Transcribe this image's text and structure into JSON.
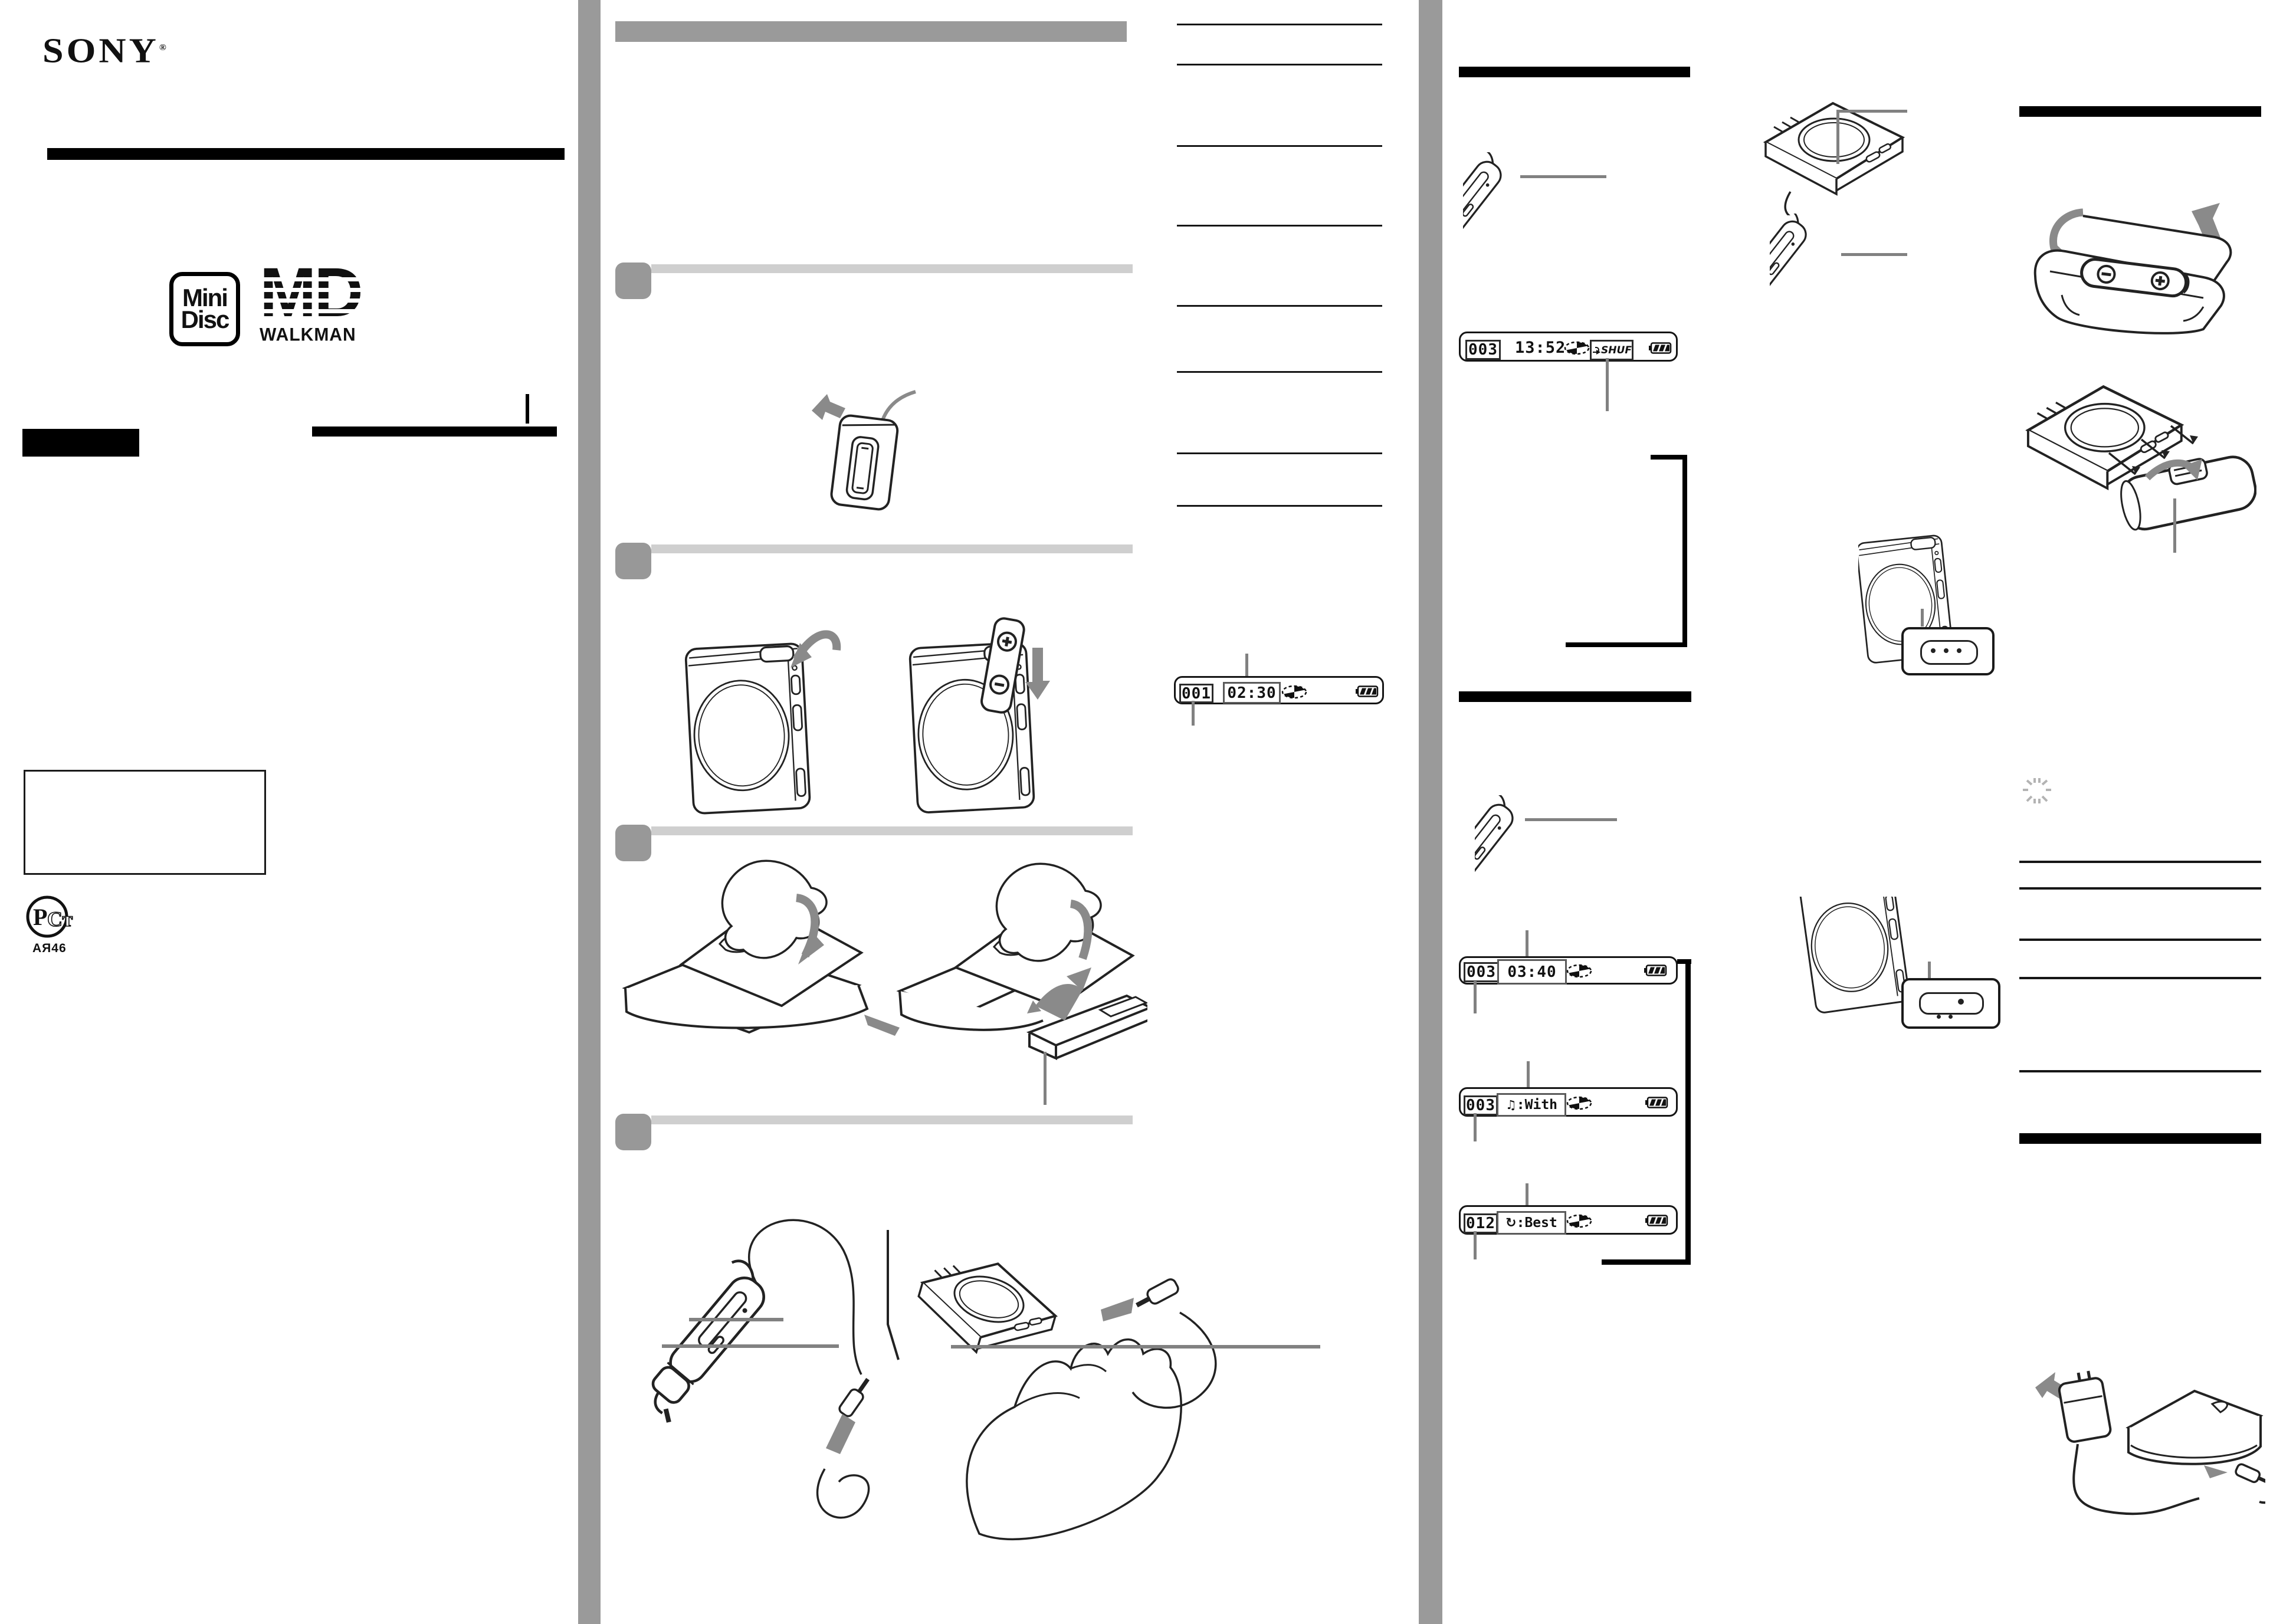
{
  "page": {
    "kind": "scanned instruction manual page",
    "divider_color": "#9a9a9a",
    "accent_black": "#000000"
  },
  "header": {
    "brand": "SONY",
    "registered_mark": "®"
  },
  "logos": {
    "minidisc": {
      "line1": "Mini",
      "line2": "Disc"
    },
    "md_walkman": {
      "md": "MD",
      "walkman": "WALKMAN"
    }
  },
  "certification": {
    "mark_p": "Р",
    "mark_ct": "Ст",
    "code": "АЯ46"
  },
  "displays": {
    "overview": {
      "track": "001",
      "time": "02:30"
    },
    "shuffle": {
      "track": "003",
      "time": "13:52",
      "mode": "SHUF"
    },
    "elapsed": {
      "track": "003",
      "time": "03:40"
    },
    "track_name": {
      "track": "003",
      "name": ":With",
      "icon": "music-note-icon",
      "note_glyph": "♫"
    },
    "disc_name": {
      "track": "012",
      "name": ":Best",
      "icon": "rotate-icon",
      "rotate_glyph": "↻"
    }
  },
  "icons": [
    "disc-icon",
    "battery-icon",
    "repeat-arrow-icon",
    "music-note-icon",
    "rotate-icon",
    "flashing-icon",
    "gost-certification-icon"
  ]
}
